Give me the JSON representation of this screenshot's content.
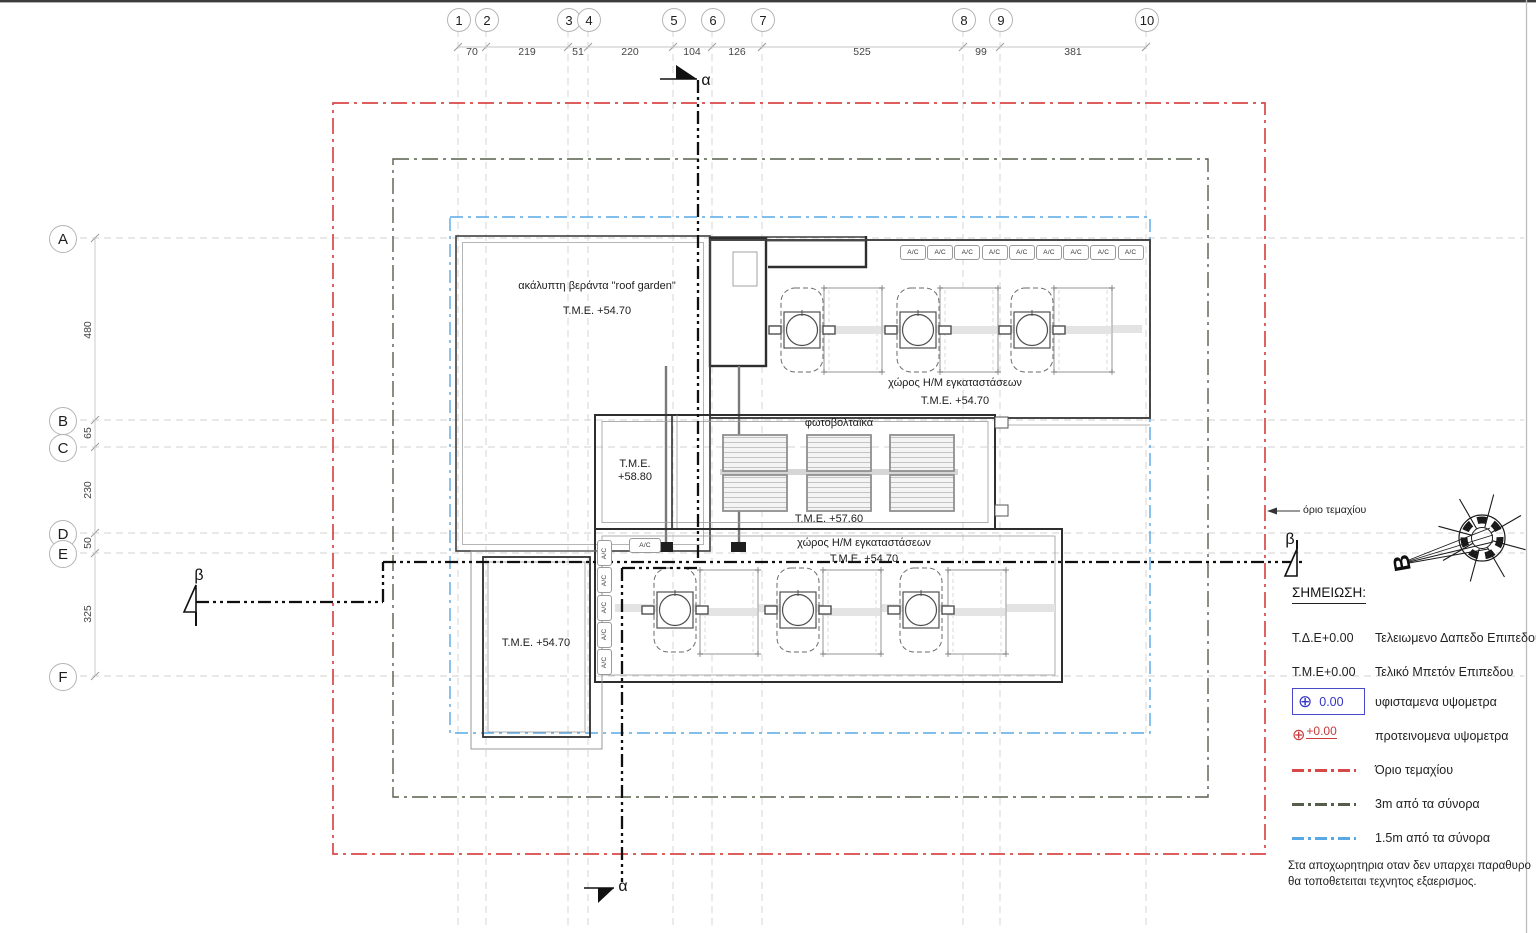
{
  "grid": {
    "columns": [
      {
        "label": "1",
        "x": 458
      },
      {
        "label": "2",
        "x": 486
      },
      {
        "label": "3",
        "x": 568
      },
      {
        "label": "4",
        "x": 588
      },
      {
        "label": "5",
        "x": 673
      },
      {
        "label": "6",
        "x": 712
      },
      {
        "label": "7",
        "x": 762
      },
      {
        "label": "8",
        "x": 963
      },
      {
        "label": "9",
        "x": 1000
      },
      {
        "label": "10",
        "x": 1146
      }
    ],
    "column_dims": [
      {
        "value": "70",
        "x": 472
      },
      {
        "value": "219",
        "x": 527
      },
      {
        "value": "51",
        "x": 578
      },
      {
        "value": "220",
        "x": 630
      },
      {
        "value": "104",
        "x": 692
      },
      {
        "value": "126",
        "x": 737
      },
      {
        "value": "525",
        "x": 862
      },
      {
        "value": "99",
        "x": 981
      },
      {
        "value": "381",
        "x": 1073
      }
    ],
    "rows": [
      {
        "label": "A",
        "y": 238
      },
      {
        "label": "B",
        "y": 420
      },
      {
        "label": "C",
        "y": 447
      },
      {
        "label": "D",
        "y": 533
      },
      {
        "label": "E",
        "y": 553
      },
      {
        "label": "F",
        "y": 676
      }
    ],
    "row_dims": [
      {
        "value": "480",
        "y": 330
      },
      {
        "value": "65",
        "y": 433
      },
      {
        "value": "230",
        "y": 490
      },
      {
        "value": "50",
        "y": 543
      },
      {
        "value": "325",
        "y": 614
      }
    ]
  },
  "plan": {
    "roof_garden": {
      "line1": "ακάλυπτη βεράντα \"roof garden\"",
      "line2": "Τ.Μ.Ε. +54.70"
    },
    "hm_top": {
      "line1": "χώρος Η/Μ εγκαταστάσεων",
      "line2": "Τ.Μ.Ε. +54.70"
    },
    "pv": {
      "title": "φωτοβολταϊκά",
      "level_left_l1": "Τ.Μ.Ε.",
      "level_left_l2": "+58.80",
      "level_bottom": "Τ.Μ.Ε. +57.60"
    },
    "hm_bottom": {
      "line1": "χώρος Η/Μ εγκαταστάσεων",
      "line2": "Τ.Μ.Ε. +54.70"
    },
    "lower_left_level": "Τ.Μ.Ε. +54.70",
    "ac_label": "A/C",
    "ac_top_count": 9,
    "ac_left_count": 5,
    "boundary_callout": "όριο τεμαχίου",
    "north_letter": "B",
    "section_alpha": "α",
    "section_beta": "β"
  },
  "legend": {
    "title": "ΣΗΜΕΙΩΣΗ:",
    "rows": [
      {
        "key": "Τ.Δ.Ε+0.00",
        "desc": "Τελειωμενο Δαπεδο Επιπεδου",
        "type": "text"
      },
      {
        "key": "Τ.Μ.Ε+0.00",
        "desc": "Τελικό Μπετόν Επιπεδου",
        "type": "text"
      },
      {
        "key": "0.00",
        "desc": "υφισταμενα υψομετρα",
        "type": "existing-elevation"
      },
      {
        "key": "+0.00",
        "desc": "προτεινομενα υψομετρα",
        "type": "proposed-elevation"
      },
      {
        "key": "",
        "desc": "Όριο τεμαχίου",
        "type": "line-red"
      },
      {
        "key": "",
        "desc": "3m από τα σύνορα",
        "type": "line-dark"
      },
      {
        "key": "",
        "desc": "1.5m από τα σύνορα",
        "type": "line-blue"
      }
    ],
    "note_lines": [
      "Στα αποχωρητηρια οταν δεν υπαρχει παραθυρο",
      "θα τοποθετειται τεχνητος εξαερισμος."
    ]
  },
  "colors": {
    "plot_boundary_red": "#d94848",
    "offset_3m_dark": "#565e4b",
    "offset_15m_blue": "#58a8e6",
    "existing_elev_blue": "#3434c4",
    "proposed_elev_red": "#c83a3a",
    "grid_gray": "#d2d2d2",
    "line_dark": "#2e2e2e"
  }
}
